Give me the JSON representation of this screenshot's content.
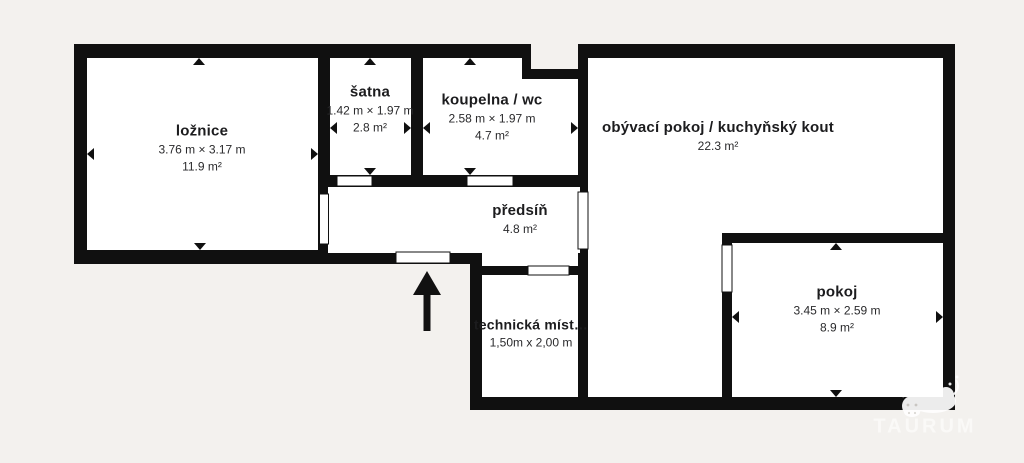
{
  "document": {
    "kind": "apartment floor plan"
  },
  "colors": {
    "background": "#f3f1ee",
    "wall": "#101010",
    "room_fill": "#ffffff",
    "text": "#1c1c1e",
    "watermark": "#ffffff"
  },
  "rooms": [
    {
      "id": "loznice",
      "name": "ložnice",
      "dimensions": "3.76 m × 3.17 m",
      "area": "11.9 m²"
    },
    {
      "id": "satna",
      "name": "šatna",
      "dimensions": "1.42 m × 1.97 m",
      "area": "2.8 m²"
    },
    {
      "id": "koupelna-wc",
      "name": "koupelna / wc",
      "dimensions": "2.58 m × 1.97 m",
      "area": "4.7 m²"
    },
    {
      "id": "obyvaci-pokoj-kuchynsky-kout",
      "name": "obývací pokoj / kuchyňský kout",
      "area": "22.3 m²"
    },
    {
      "id": "predsin",
      "name": "předsíň",
      "area": "4.8 m²"
    },
    {
      "id": "technicka-mistnost",
      "name": "technická míst…",
      "dimensions": "1,50m x 2,00 m"
    },
    {
      "id": "pokoj",
      "name": "pokoj",
      "dimensions": "3.45 m × 2.59 m",
      "area": "8.9 m²"
    }
  ],
  "icons": {
    "entrance_arrow": "up-arrow",
    "dimension_marker": "small-triangle-wall-pointer",
    "watermark_logo": "bull-silhouette"
  },
  "watermark": {
    "text": "TAURUM"
  }
}
